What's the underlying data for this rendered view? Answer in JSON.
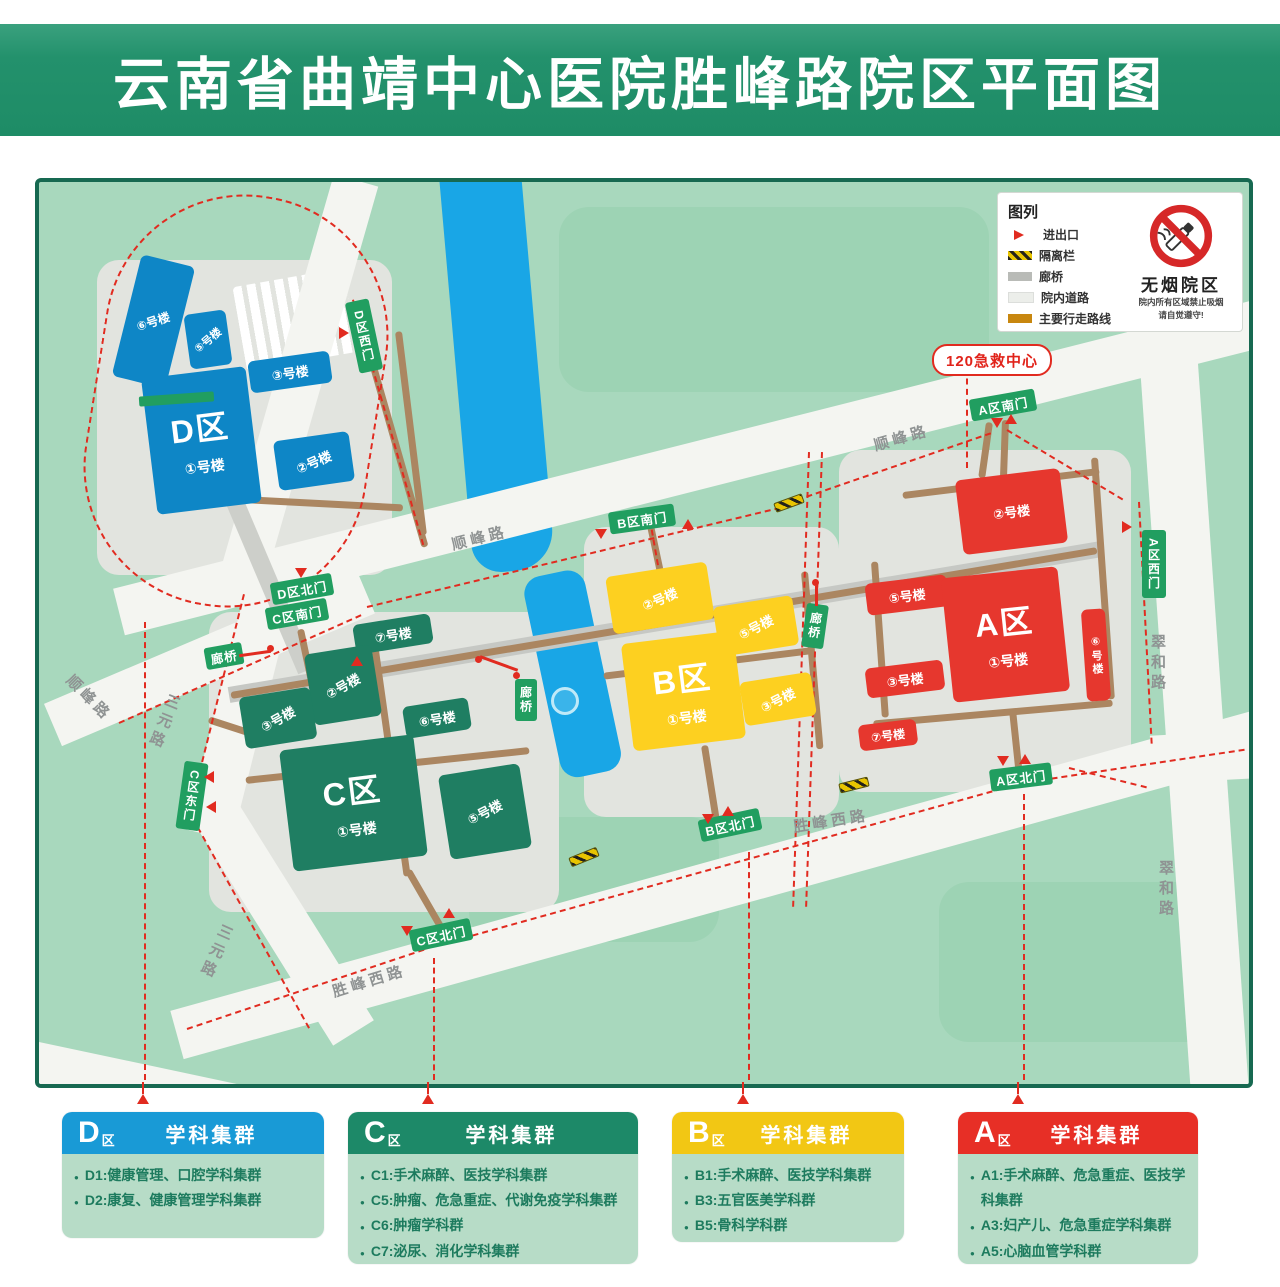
{
  "title": "云南省曲靖中心医院胜峰路院区平面图",
  "legend": {
    "title": "图列",
    "items": [
      "进出口",
      "隔离栏",
      "廊桥",
      "院内道路",
      "主要行走路线"
    ]
  },
  "no_smoking": {
    "title": "无烟院区",
    "line1": "院内所有区域禁止吸烟",
    "line2": "请自觉遵守!"
  },
  "emergency": "120急救中心",
  "corridor": "廊桥",
  "roads": {
    "shunfeng": "顺峰路",
    "sanyuan": "三元路",
    "shengfengxi": "胜峰西路",
    "cuihe": "翠和路"
  },
  "colors": {
    "zone_a": "#e6372e",
    "zone_b": "#fdd020",
    "zone_c": "#1f7e62",
    "zone_d": "#0e86c6",
    "gate": "#219e60",
    "route": "#e12b20",
    "walkway": "#ab8661"
  },
  "zones": {
    "d": {
      "label": "D区",
      "main": "①号楼",
      "b2": "②号楼",
      "b3": "③号楼",
      "b5": "⑤号楼",
      "b6": "⑥号楼",
      "gates": {
        "west": "D区西门",
        "north": "D区北门"
      }
    },
    "c": {
      "label": "C区",
      "main": "①号楼",
      "b2": "②号楼",
      "b3": "③号楼",
      "b5": "⑤号楼",
      "b6": "⑥号楼",
      "b7": "⑦号楼",
      "gates": {
        "south": "C区南门",
        "east": "C区东门",
        "north": "C区北门"
      }
    },
    "b": {
      "label": "B区",
      "main": "①号楼",
      "b2": "②号楼",
      "b3": "③号楼",
      "b5": "⑤号楼",
      "gates": {
        "south": "B区南门",
        "north": "B区北门"
      }
    },
    "a": {
      "label": "A区",
      "main": "①号楼",
      "b2": "②号楼",
      "b3": "③号楼",
      "b5": "⑤号楼",
      "b6": "⑥号楼",
      "b7": "⑦号楼",
      "gates": {
        "south": "A区南门",
        "west": "A区西门",
        "north": "A区北门"
      }
    }
  },
  "cards": [
    {
      "letter": "D",
      "suffix": "区",
      "title": "学科集群",
      "items": [
        "D1:健康管理、口腔学科集群",
        "D2:康复、健康管理学科集群"
      ]
    },
    {
      "letter": "C",
      "suffix": "区",
      "title": "学科集群",
      "items": [
        "C1:手术麻醉、医技学科集群",
        "C5:肿瘤、危急重症、代谢免疫学科集群",
        "C6:肿瘤学科群",
        "C7:泌尿、消化学科集群"
      ]
    },
    {
      "letter": "B",
      "suffix": "区",
      "title": "学科集群",
      "items": [
        "B1:手术麻醉、医技学科集群",
        "B3:五官医美学科群",
        "B5:骨科学科群"
      ]
    },
    {
      "letter": "A",
      "suffix": "区",
      "title": "学科集群",
      "items": [
        "A1:手术麻醉、危急重症、医技学科集群",
        "A3:妇产儿、危急重症学科集群",
        "A5:心脑血管学科群"
      ]
    }
  ]
}
